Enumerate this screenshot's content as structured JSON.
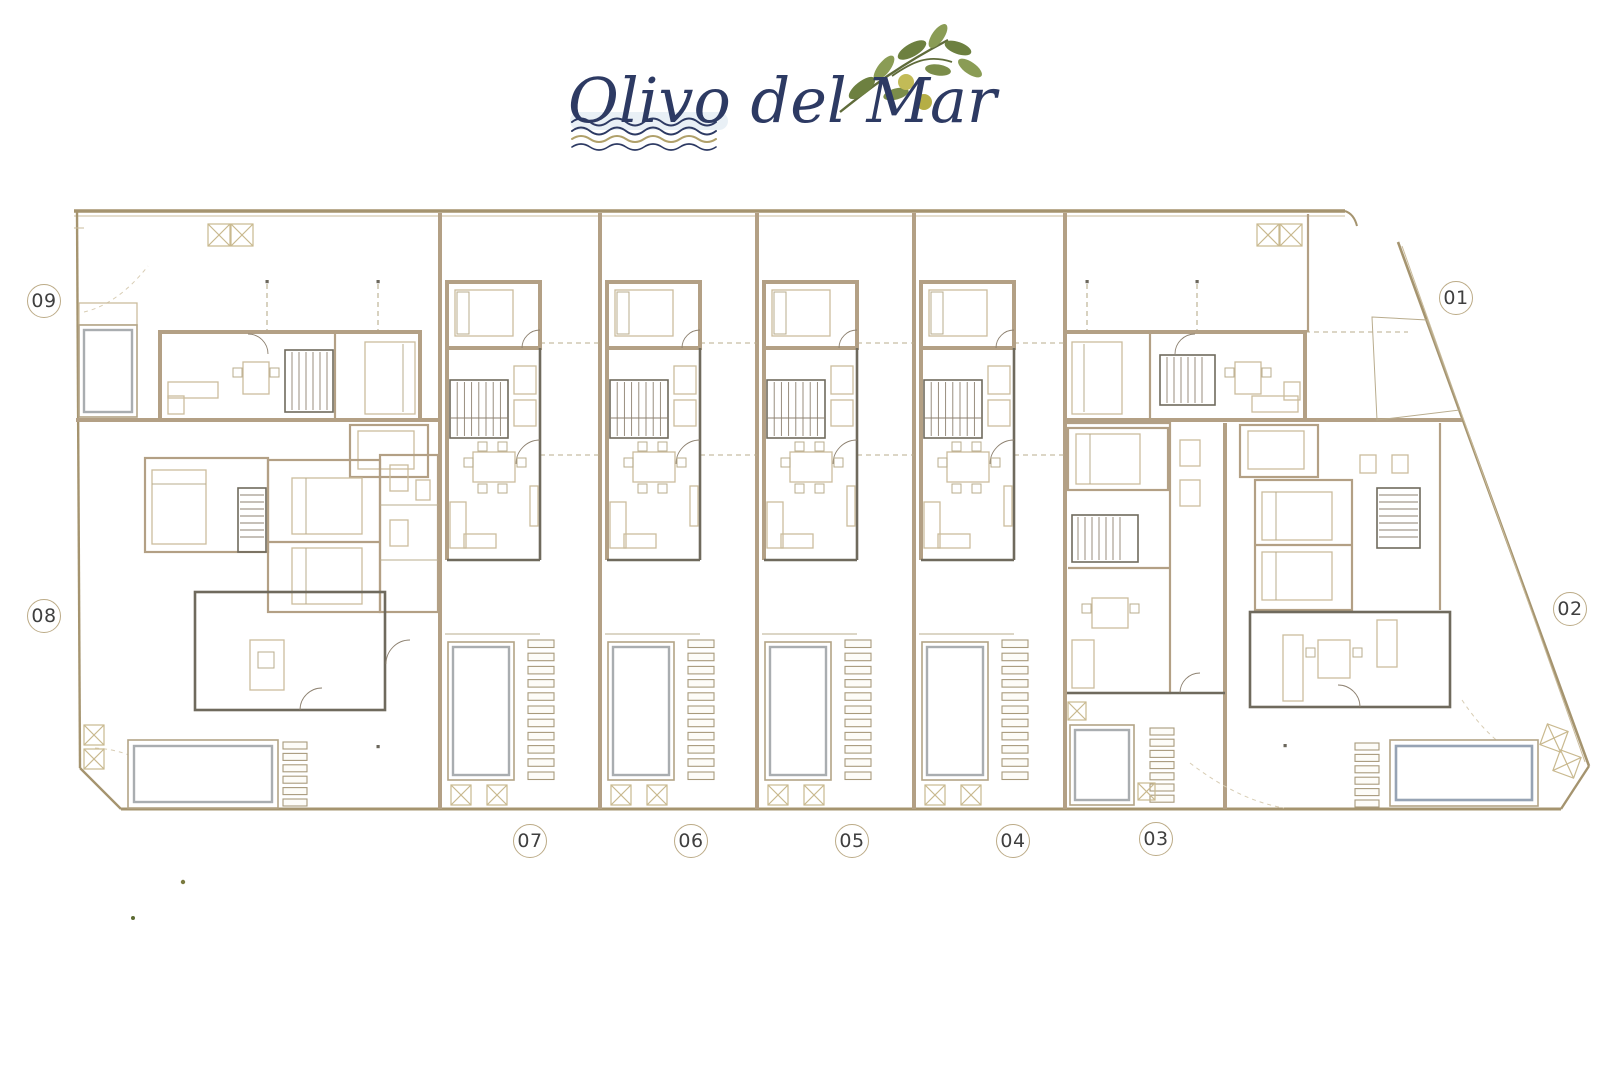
{
  "logo": {
    "text": "Olivo del Mar"
  },
  "units": [
    {
      "label": "01"
    },
    {
      "label": "02"
    },
    {
      "label": "03"
    },
    {
      "label": "04"
    },
    {
      "label": "05"
    },
    {
      "label": "06"
    },
    {
      "label": "07"
    },
    {
      "label": "08"
    },
    {
      "label": "09"
    }
  ],
  "colors": {
    "logo_navy": "#2d3a63",
    "olive_leaf_dark": "#6d8040",
    "olive_leaf_light": "#8a9c55",
    "olive_fruit": "#c2bb57",
    "wave_tan": "#b0a06a",
    "wall_tan": "#b3a085",
    "wall_dark": "#6f6a5d",
    "boundary_tan": "#a5946f",
    "pool_blue_grey": "#96a3b4",
    "label_text": "#3f3f3f"
  }
}
